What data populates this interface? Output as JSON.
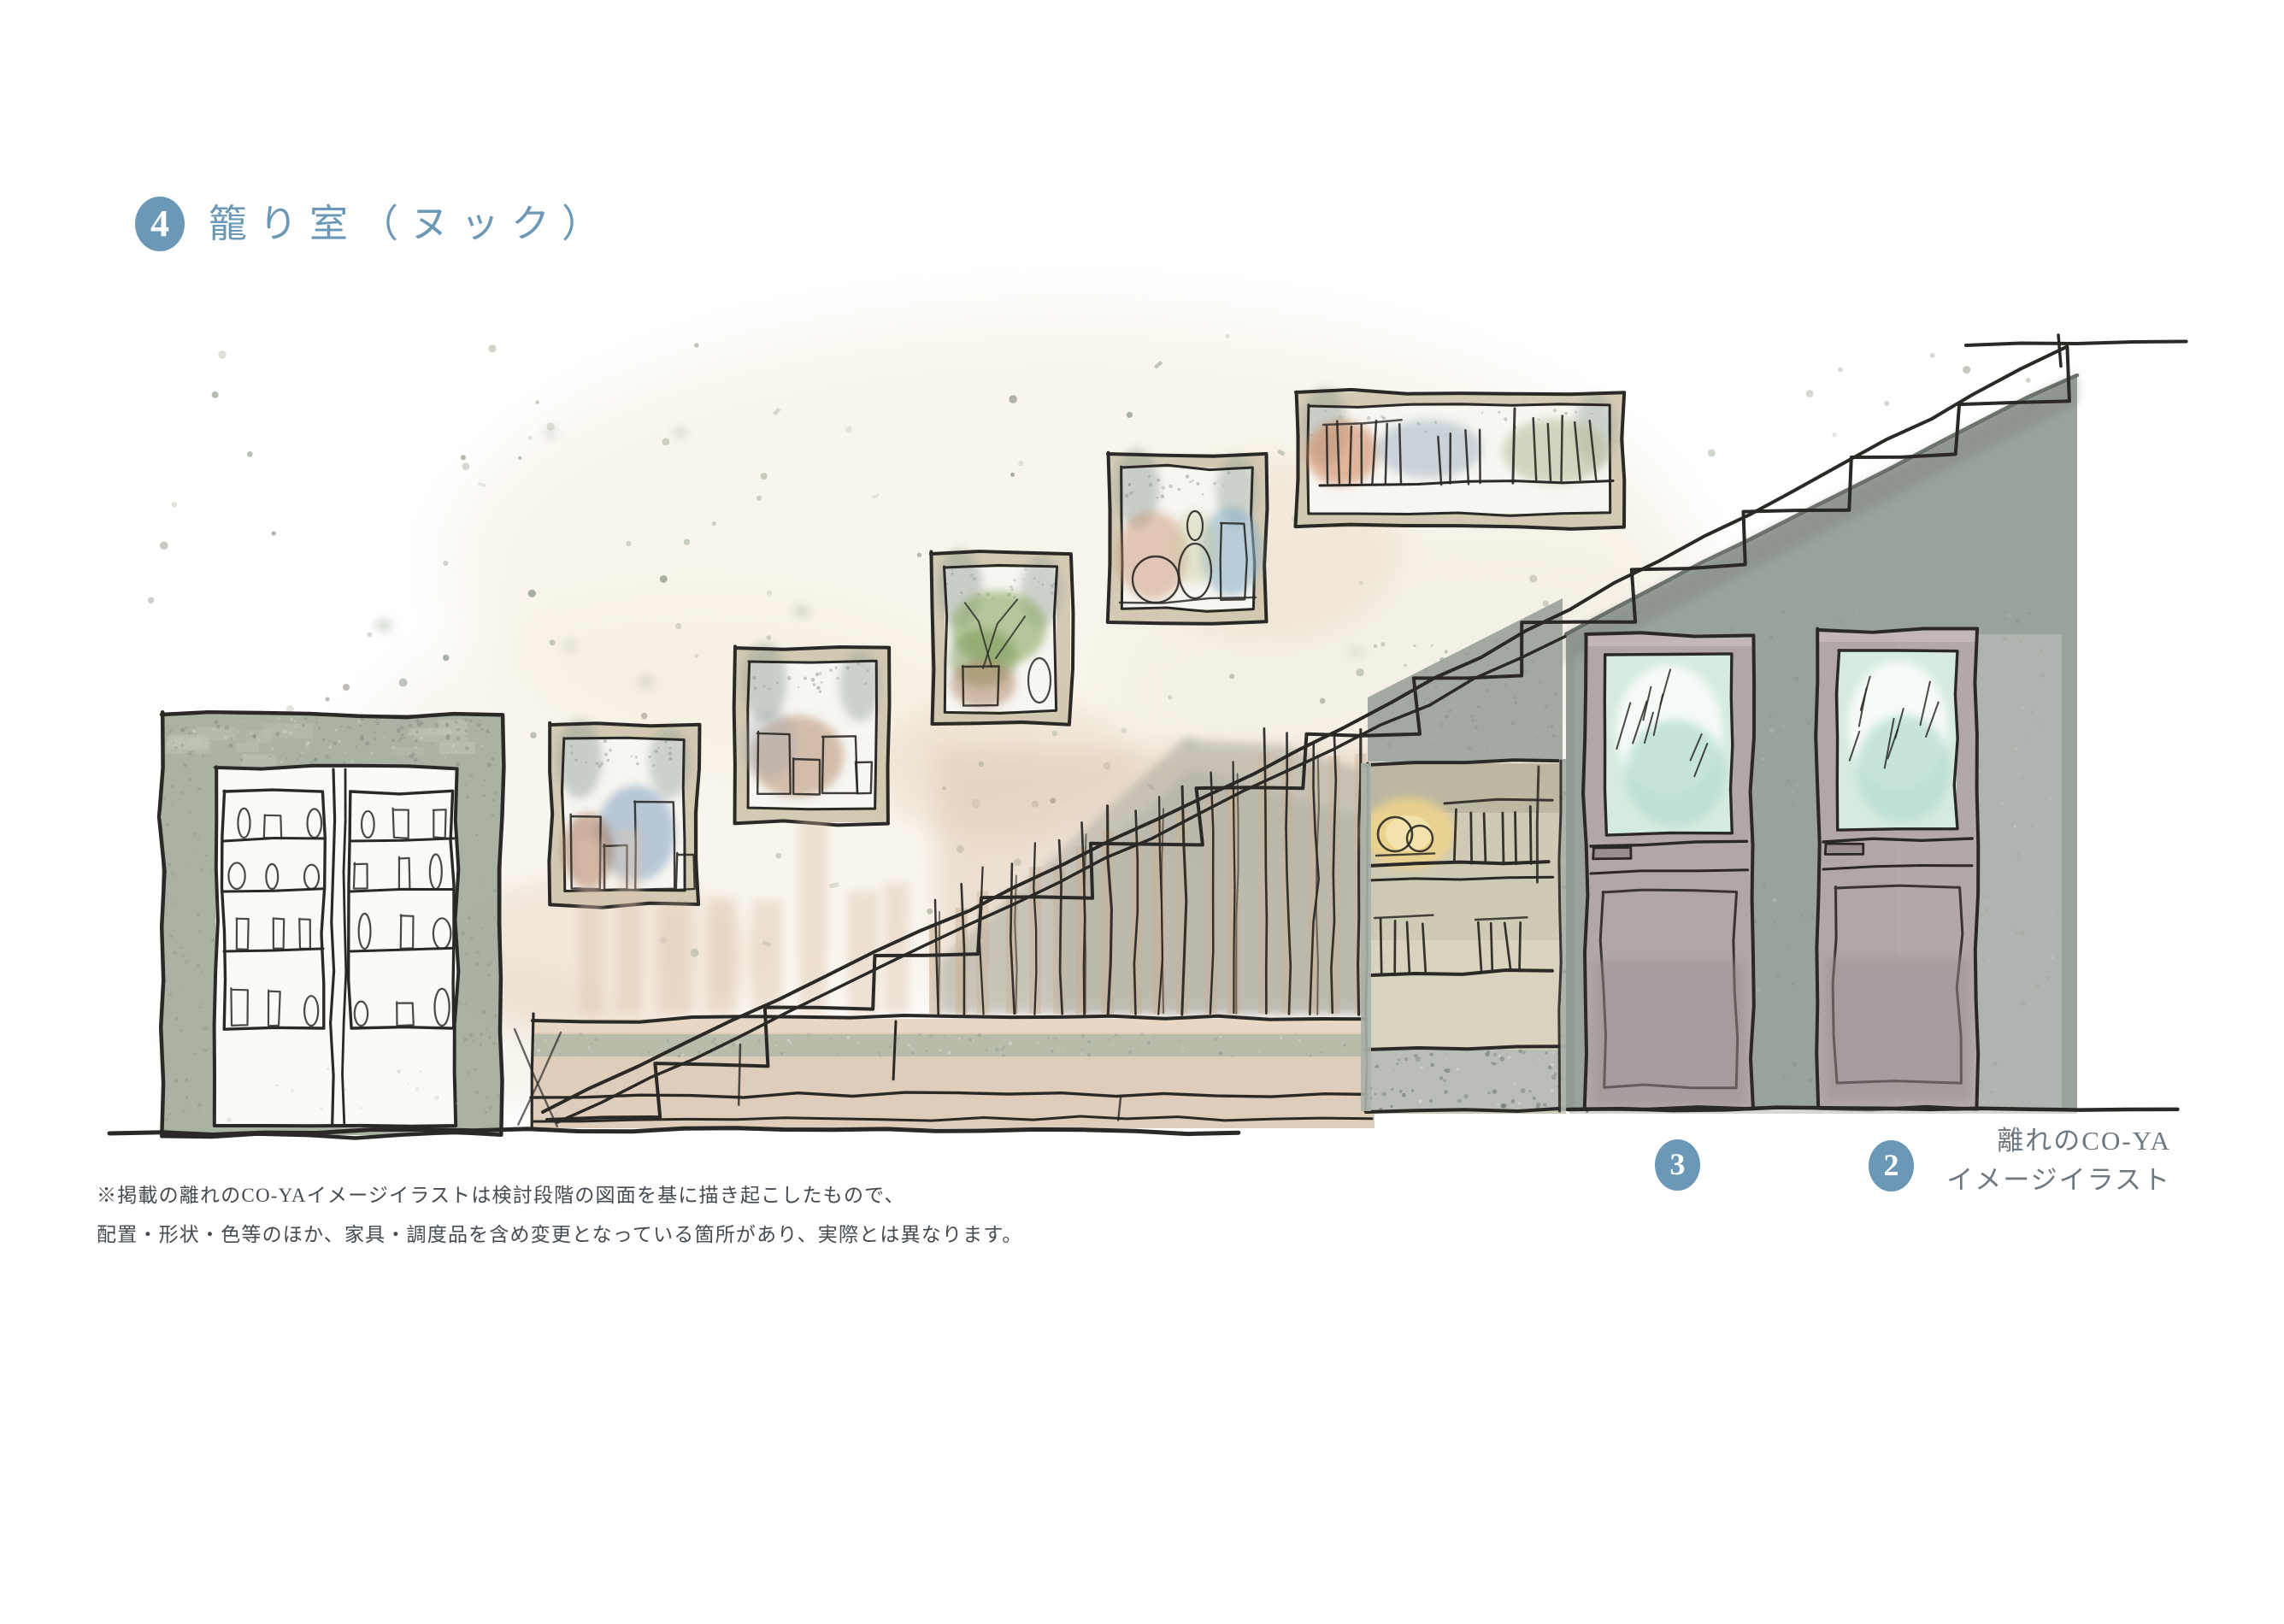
{
  "header": {
    "number": "4",
    "title": "籠り室（ヌック）"
  },
  "markers": [
    {
      "label": "3"
    },
    {
      "label": "2"
    }
  ],
  "caption": {
    "line1": "離れのCO-YA",
    "line2": "イメージイラスト"
  },
  "disclaimer": {
    "line1": "※掲載の離れのCO-YAイメージイラストは検討段階の図面を基に描き起こしたもので、",
    "line2": "配置・形状・色等のほか、家具・調度品を含め変更となっている箇所があり、実際とは異なります。"
  },
  "colors": {
    "accent": "#6b98b7",
    "caption_text": "#6e7880",
    "note_text": "#454b51",
    "ink": "#2b2926",
    "wall_gray": "#9aa29c",
    "cabinet_sage": "#a5ae9f",
    "frame_beige": "#cfc6ae",
    "wood_tan": "#cab093",
    "bench_beige": "#dcc9b6",
    "bench_stripe": "#b2b9a8",
    "door_mauve": "#b3a7a7",
    "glass_mint": "#d6ebdf",
    "lamp_glow": "#ecd28c"
  }
}
